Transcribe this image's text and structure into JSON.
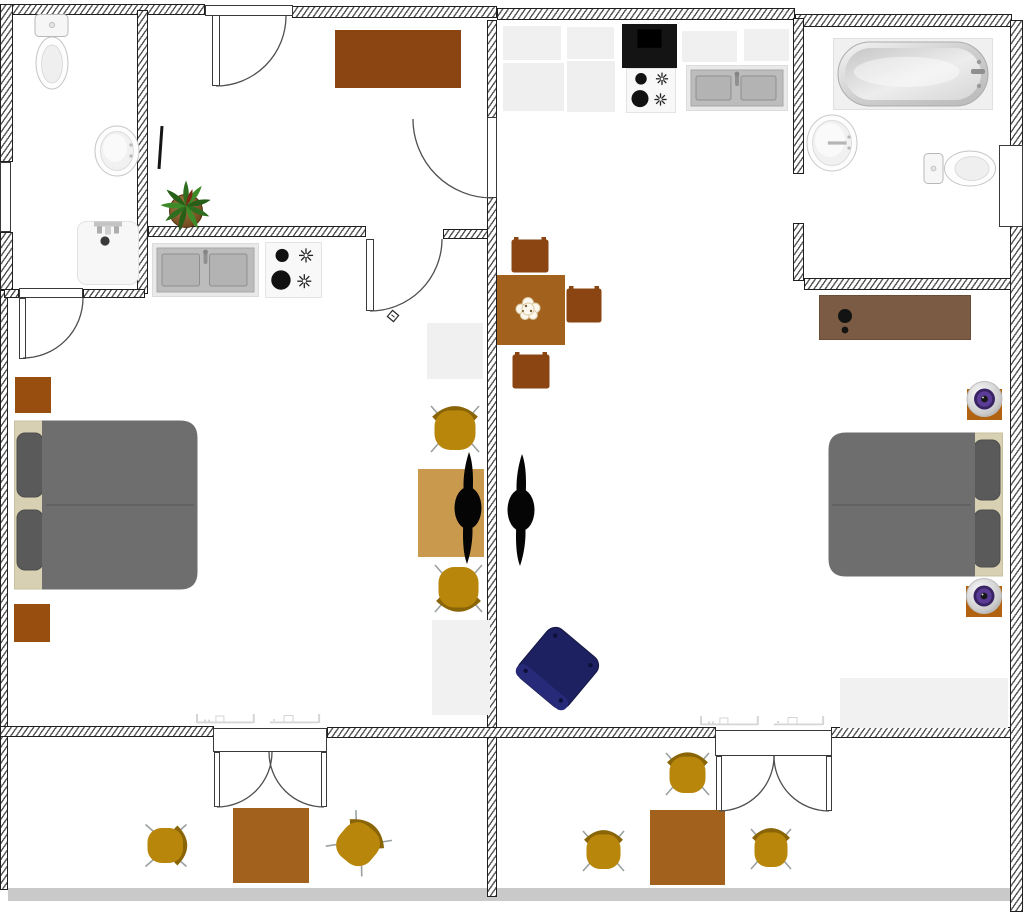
{
  "canvas": {
    "width": 1024,
    "height": 916,
    "background": "#ffffff"
  },
  "palette": {
    "wall_hatch": "#555555",
    "wall_border": "#1f1f1f",
    "arc_stroke": "#4f4f4f",
    "brownDark": "#8a4513",
    "brownMid": "#a2611c",
    "brownNight": "#974e0e",
    "tan": "#c99a4e",
    "gold": "#b8860b",
    "goldBack": "#8a6508",
    "legGray": "#9aa0a0",
    "bedBody": "#6e6e6e",
    "bedPillow": "#5a5a5a",
    "bedFrame": "#d8d0b2",
    "dresser": "#7b5b43",
    "navy": "#1d2061",
    "speakerPurple": "#5a3c96",
    "speakerBase": "#b26312",
    "cabinet": "#f0f0f0",
    "sinkSteel": "#bcbcbc",
    "floorStrip": "#c9c9c9",
    "plantGreen": "#2e6e1e",
    "potBrown": "#8a5a2e"
  },
  "items": [
    {
      "n": "balcony-floor-strip",
      "k": "rect",
      "x": 8,
      "y": 888,
      "w": 1015,
      "h": 13,
      "c": "floorStrip",
      "i": false
    },
    {
      "n": "wall-top-left",
      "k": "wall",
      "x": 8,
      "y": 4,
      "w": 197,
      "h": 11,
      "i": false
    },
    {
      "n": "wall-top-mid",
      "k": "wall",
      "x": 292,
      "y": 6,
      "w": 205,
      "h": 12,
      "i": false
    },
    {
      "n": "wall-top-right",
      "k": "wall",
      "x": 497,
      "y": 8,
      "w": 298,
      "h": 12,
      "i": false
    },
    {
      "n": "wall-top-far-right",
      "k": "wall",
      "x": 795,
      "y": 14,
      "w": 217,
      "h": 13,
      "i": false
    },
    {
      "n": "wall-right",
      "k": "wall",
      "x": 1010,
      "y": 20,
      "w": 13,
      "h": 892,
      "i": false
    },
    {
      "n": "wall-left-upper",
      "k": "wall",
      "x": 0,
      "y": 4,
      "w": 13,
      "h": 158,
      "i": false
    },
    {
      "n": "wall-left-mid",
      "k": "wall",
      "x": 0,
      "y": 232,
      "w": 13,
      "h": 58,
      "i": false
    },
    {
      "n": "wall-left-lower",
      "k": "wall",
      "x": 0,
      "y": 290,
      "w": 8,
      "h": 600,
      "i": false
    },
    {
      "n": "wall-bath-left-east",
      "k": "wall",
      "x": 137,
      "y": 10,
      "w": 11,
      "h": 284,
      "i": false
    },
    {
      "n": "wall-bath-left-bottom-west",
      "k": "wall",
      "x": 4,
      "y": 289,
      "w": 15,
      "h": 9,
      "i": false
    },
    {
      "n": "wall-bath-left-bottom-east",
      "k": "wall",
      "x": 83,
      "y": 289,
      "w": 62,
      "h": 9,
      "i": false
    },
    {
      "n": "wall-kitchen-left-west",
      "k": "wall",
      "x": 148,
      "y": 226,
      "w": 218,
      "h": 11,
      "i": false
    },
    {
      "n": "wall-kitchen-left-east",
      "k": "wall",
      "x": 443,
      "y": 229,
      "w": 54,
      "h": 10,
      "i": false
    },
    {
      "n": "wall-divider-upper",
      "k": "wall",
      "x": 487,
      "y": 20,
      "w": 10,
      "h": 98,
      "i": false
    },
    {
      "n": "wall-divider-main",
      "k": "wall",
      "x": 487,
      "y": 197,
      "w": 10,
      "h": 534,
      "i": false
    },
    {
      "n": "wall-divider-balcony",
      "k": "wall",
      "x": 487,
      "y": 731,
      "w": 10,
      "h": 166,
      "i": false
    },
    {
      "n": "wall-bath-right-west-upper",
      "k": "wall",
      "x": 793,
      "y": 18,
      "w": 11,
      "h": 156,
      "i": false
    },
    {
      "n": "wall-bath-right-west-lower",
      "k": "wall",
      "x": 793,
      "y": 223,
      "w": 11,
      "h": 58,
      "i": false
    },
    {
      "n": "wall-bath-right-bottom",
      "k": "wall",
      "x": 804,
      "y": 278,
      "w": 207,
      "h": 12,
      "i": false
    },
    {
      "n": "wall-balcony-west",
      "k": "wall",
      "x": 0,
      "y": 726,
      "w": 214,
      "h": 11,
      "i": false
    },
    {
      "n": "wall-balcony-mid",
      "k": "wall",
      "x": 327,
      "y": 727,
      "w": 389,
      "h": 11,
      "i": false
    },
    {
      "n": "wall-balcony-east",
      "k": "wall",
      "x": 831,
      "y": 727,
      "w": 180,
      "h": 11,
      "i": false
    },
    {
      "n": "window-left",
      "k": "win",
      "x": 0,
      "y": 162,
      "w": 11,
      "h": 70,
      "i": false
    },
    {
      "n": "radiator-marks-left",
      "k": "marks",
      "x": 196,
      "y": 706,
      "w": 142,
      "h": 18,
      "i": false
    },
    {
      "n": "radiator-marks-right",
      "k": "marks",
      "x": 700,
      "y": 708,
      "w": 142,
      "h": 18,
      "i": false
    },
    {
      "n": "radiator-marks-far-right",
      "k": "marks",
      "x": 893,
      "y": 700,
      "w": 52,
      "h": 14,
      "i": false
    },
    {
      "n": "door-frame-top",
      "k": "rect",
      "x": 205,
      "y": 5,
      "w": 88,
      "h": 11,
      "c": "#ffffff",
      "b": "#3a3a3a",
      "i": true
    },
    {
      "n": "door-leaf-top",
      "k": "rect",
      "x": 212,
      "y": 15,
      "w": 8,
      "h": 71,
      "c": "#ffffff",
      "b": "#3a3a3a",
      "i": true
    },
    {
      "n": "door-frame-bedroom-left",
      "k": "rect",
      "x": 19,
      "y": 288,
      "w": 64,
      "h": 10,
      "c": "#ffffff",
      "b": "#3a3a3a",
      "i": true
    },
    {
      "n": "door-leaf-bedroom-left",
      "k": "rect",
      "x": 19,
      "y": 298,
      "w": 7,
      "h": 61,
      "c": "#ffffff",
      "b": "#3a3a3a",
      "i": true
    },
    {
      "n": "door-leaf-divider",
      "k": "rect",
      "x": 487,
      "y": 117,
      "w": 10,
      "h": 81,
      "c": "#ffffff",
      "b": "#3a3a3a",
      "i": true
    },
    {
      "n": "door-leaf-kitchen-left",
      "k": "rect",
      "x": 366,
      "y": 239,
      "w": 8,
      "h": 72,
      "c": "#ffffff",
      "b": "#3a3a3a",
      "i": true
    },
    {
      "n": "door-frame-balcony-left",
      "k": "rect",
      "x": 213,
      "y": 728,
      "w": 114,
      "h": 24,
      "c": "#ffffff",
      "b": "#3a3a3a",
      "i": true
    },
    {
      "n": "door-leaf-balcony-left-a",
      "k": "rect",
      "x": 214,
      "y": 752,
      "w": 6,
      "h": 55,
      "c": "#ffffff",
      "b": "#3a3a3a",
      "i": true
    },
    {
      "n": "door-leaf-balcony-left-b",
      "k": "rect",
      "x": 321,
      "y": 752,
      "w": 6,
      "h": 55,
      "c": "#ffffff",
      "b": "#3a3a3a",
      "i": true
    },
    {
      "n": "door-frame-balcony-right",
      "k": "rect",
      "x": 715,
      "y": 730,
      "w": 117,
      "h": 26,
      "c": "#ffffff",
      "b": "#3a3a3a",
      "i": true
    },
    {
      "n": "door-leaf-balcony-right-a",
      "k": "rect",
      "x": 716,
      "y": 756,
      "w": 6,
      "h": 55,
      "c": "#ffffff",
      "b": "#3a3a3a",
      "i": true
    },
    {
      "n": "door-leaf-balcony-right-b",
      "k": "rect",
      "x": 826,
      "y": 756,
      "w": 6,
      "h": 55,
      "c": "#ffffff",
      "b": "#3a3a3a",
      "i": true
    },
    {
      "n": "door-leaf-bath-right",
      "k": "rect",
      "x": 999,
      "y": 145,
      "w": 24,
      "h": 82,
      "c": "#ffffff",
      "b": "#3a3a3a",
      "i": true
    },
    {
      "n": "toilet-left-bath",
      "k": "toiletV",
      "x": 33,
      "y": 13,
      "w": 38,
      "h": 78,
      "i": true
    },
    {
      "n": "sink-left-bath",
      "k": "sinkRound",
      "x": 94,
      "y": 125,
      "w": 46,
      "h": 52,
      "i": true
    },
    {
      "n": "shower-tray",
      "k": "shower",
      "x": 77,
      "y": 221,
      "w": 62,
      "h": 64,
      "i": true
    },
    {
      "n": "desk",
      "k": "rect",
      "x": 335,
      "y": 30,
      "w": 126,
      "h": 58,
      "c": "brownDark",
      "i": true
    },
    {
      "n": "pen-object",
      "k": "rect",
      "x": 159,
      "y": 126,
      "w": 3,
      "h": 43,
      "c": "#151515",
      "rot": 4,
      "i": true
    },
    {
      "n": "potted-plant",
      "k": "plant",
      "x": 158,
      "y": 180,
      "w": 56,
      "h": 52,
      "i": true
    },
    {
      "n": "door-stop-symbol",
      "k": "diamond",
      "x": 386,
      "y": 309,
      "w": 14,
      "h": 14,
      "i": false
    },
    {
      "n": "kitchen-sink-left",
      "k": "ksink",
      "x": 152,
      "y": 243,
      "w": 107,
      "h": 54,
      "i": true
    },
    {
      "n": "stove-left",
      "k": "stove",
      "x": 265,
      "y": 242,
      "w": 57,
      "h": 56,
      "i": true
    },
    {
      "n": "cabinet-small-left",
      "k": "rect",
      "x": 427,
      "y": 323,
      "w": 56,
      "h": 56,
      "c": "cabinet",
      "i": true
    },
    {
      "n": "wardrobe-left",
      "k": "rect",
      "x": 432,
      "y": 620,
      "w": 58,
      "h": 95,
      "c": "#f1f1f1",
      "i": true
    },
    {
      "n": "side-table-tan",
      "k": "rect",
      "x": 418,
      "y": 469,
      "w": 66,
      "h": 88,
      "c": "tan",
      "i": true
    },
    {
      "n": "chair-desk-top",
      "k": "chairG",
      "x": 430,
      "y": 402,
      "w": 50,
      "h": 52,
      "rot": 0,
      "i": true
    },
    {
      "n": "chair-desk-bottom",
      "k": "chairG",
      "x": 434,
      "y": 563,
      "w": 49,
      "h": 53,
      "rot": 180,
      "i": true
    },
    {
      "n": "ceiling-fan-left",
      "k": "fan",
      "x": 452,
      "y": 450,
      "w": 32,
      "h": 116,
      "i": true
    },
    {
      "n": "ceiling-fan-right",
      "k": "fan",
      "x": 505,
      "y": 452,
      "w": 32,
      "h": 116,
      "i": true
    },
    {
      "n": "nightstand-top",
      "k": "rect",
      "x": 15,
      "y": 377,
      "w": 36,
      "h": 36,
      "c": "brownNight",
      "i": true
    },
    {
      "n": "double-bed-left",
      "k": "bed",
      "x": 14,
      "y": 420,
      "w": 184,
      "h": 170,
      "side": "left",
      "i": true
    },
    {
      "n": "nightstand-bottom",
      "k": "rect",
      "x": 14,
      "y": 604,
      "w": 36,
      "h": 38,
      "c": "brownNight",
      "i": true
    },
    {
      "n": "dining-chair-north",
      "k": "chairD",
      "x": 511,
      "y": 237,
      "w": 38,
      "h": 36,
      "i": true
    },
    {
      "n": "dining-table",
      "k": "rect",
      "x": 497,
      "y": 275,
      "w": 68,
      "h": 70,
      "c": "brownMid",
      "i": true
    },
    {
      "n": "table-flower",
      "k": "flower",
      "x": 510,
      "y": 290,
      "w": 36,
      "h": 34,
      "i": false
    },
    {
      "n": "dining-chair-east",
      "k": "chairD",
      "x": 566,
      "y": 286,
      "w": 36,
      "h": 37,
      "i": true
    },
    {
      "n": "dining-chair-south",
      "k": "chairD",
      "x": 512,
      "y": 352,
      "w": 38,
      "h": 37,
      "i": true
    },
    {
      "n": "cabinet-1",
      "k": "rect",
      "x": 503,
      "y": 26,
      "w": 58,
      "h": 34,
      "c": "cabinet",
      "i": true
    },
    {
      "n": "cabinet-2",
      "k": "rect",
      "x": 503,
      "y": 63,
      "w": 61,
      "h": 48,
      "c": "#efefef",
      "i": true
    },
    {
      "n": "cabinet-3",
      "k": "rect",
      "x": 567,
      "y": 27,
      "w": 47,
      "h": 32,
      "c": "cabinet",
      "i": true
    },
    {
      "n": "cabinet-4",
      "k": "rect",
      "x": 567,
      "y": 61,
      "w": 48,
      "h": 51,
      "c": "#efefef",
      "i": true
    },
    {
      "n": "range-hood",
      "k": "hood",
      "x": 622,
      "y": 24,
      "w": 55,
      "h": 44,
      "i": true
    },
    {
      "n": "stove-right",
      "k": "stove",
      "x": 626,
      "y": 68,
      "w": 50,
      "h": 45,
      "i": true
    },
    {
      "n": "kitchen-sink-right",
      "k": "ksink",
      "x": 686,
      "y": 65,
      "w": 102,
      "h": 46,
      "i": true
    },
    {
      "n": "cabinet-5",
      "k": "rect",
      "x": 682,
      "y": 31,
      "w": 55,
      "h": 31,
      "c": "cabinet",
      "i": true
    },
    {
      "n": "cabinet-6",
      "k": "rect",
      "x": 744,
      "y": 29,
      "w": 45,
      "h": 32,
      "c": "cabinet",
      "i": true
    },
    {
      "n": "bathtub",
      "k": "tub",
      "x": 833,
      "y": 38,
      "w": 160,
      "h": 72,
      "i": true
    },
    {
      "n": "sink-right-bath",
      "k": "sinkRound",
      "x": 806,
      "y": 114,
      "w": 52,
      "h": 58,
      "hb": true,
      "i": true
    },
    {
      "n": "toilet-right-bath",
      "k": "toiletH",
      "x": 923,
      "y": 149,
      "w": 74,
      "h": 39,
      "i": true
    },
    {
      "n": "dresser",
      "k": "dresser",
      "x": 819,
      "y": 295,
      "w": 152,
      "h": 45,
      "i": true
    },
    {
      "n": "speaker-top",
      "k": "speaker",
      "x": 966,
      "y": 381,
      "w": 37,
      "h": 40,
      "i": true
    },
    {
      "n": "double-bed-right",
      "k": "bed",
      "x": 828,
      "y": 432,
      "w": 175,
      "h": 145,
      "side": "right",
      "i": true
    },
    {
      "n": "speaker-bottom",
      "k": "speaker",
      "x": 965,
      "y": 578,
      "w": 38,
      "h": 40,
      "i": true
    },
    {
      "n": "sideboard-low-right",
      "k": "rect",
      "x": 840,
      "y": 678,
      "w": 168,
      "h": 50,
      "c": "#f1f1f1",
      "i": true
    },
    {
      "n": "armchair-blue",
      "k": "bluechair",
      "x": 518,
      "y": 628,
      "w": 80,
      "h": 80,
      "rot": 40,
      "i": true
    },
    {
      "n": "balcony-chair-left-west",
      "k": "chairG",
      "x": 145,
      "y": 822,
      "w": 44,
      "h": 47,
      "rot": 90,
      "i": true
    },
    {
      "n": "balcony-table-left",
      "k": "rect",
      "x": 233,
      "y": 808,
      "w": 76,
      "h": 75,
      "c": "brownMid",
      "i": true
    },
    {
      "n": "balcony-chair-left-east",
      "k": "chairG",
      "x": 335,
      "y": 816,
      "w": 49,
      "h": 53,
      "rot": 40,
      "i": true
    },
    {
      "n": "balcony-chair-right-north",
      "k": "chairG",
      "x": 665,
      "y": 749,
      "w": 45,
      "h": 48,
      "rot": 0,
      "i": true
    },
    {
      "n": "balcony-table-right",
      "k": "rect",
      "x": 650,
      "y": 810,
      "w": 75,
      "h": 75,
      "c": "brownMid",
      "i": true
    },
    {
      "n": "balcony-chair-right-west",
      "k": "chairG",
      "x": 582,
      "y": 827,
      "w": 43,
      "h": 46,
      "rot": 0,
      "i": true
    },
    {
      "n": "balcony-chair-right-east",
      "k": "chairG",
      "x": 750,
      "y": 825,
      "w": 42,
      "h": 46,
      "rot": 0,
      "i": true
    },
    {
      "n": "door-arc-top",
      "k": "arc",
      "d": "M216 86 A70 70 0 0 0 286 16",
      "i": false
    },
    {
      "n": "door-arc-divider",
      "k": "arc",
      "d": "M492 198 A79 79 0 0 1 413 119",
      "i": false
    },
    {
      "n": "door-arc-kitchen-left",
      "k": "arc",
      "d": "M370 311 A72 72 0 0 0 442 239",
      "i": false
    },
    {
      "n": "door-arc-bedroom-left",
      "k": "arc",
      "d": "M83 298 A60 60 0 0 1 23 358",
      "i": false
    },
    {
      "n": "door-arc-balcony-left-a",
      "k": "arc",
      "d": "M217 807 A55 55 0 0 0 272 752",
      "i": false
    },
    {
      "n": "door-arc-balcony-left-b",
      "k": "arc",
      "d": "M324 807 A55 55 0 0 1 269 752",
      "i": false
    },
    {
      "n": "door-arc-balcony-right-a",
      "k": "arc",
      "d": "M719 811 A55 55 0 0 0 774 756",
      "i": false
    },
    {
      "n": "door-arc-balcony-right-b",
      "k": "arc",
      "d": "M829 811 A55 55 0 0 1 774 756",
      "i": false
    }
  ]
}
